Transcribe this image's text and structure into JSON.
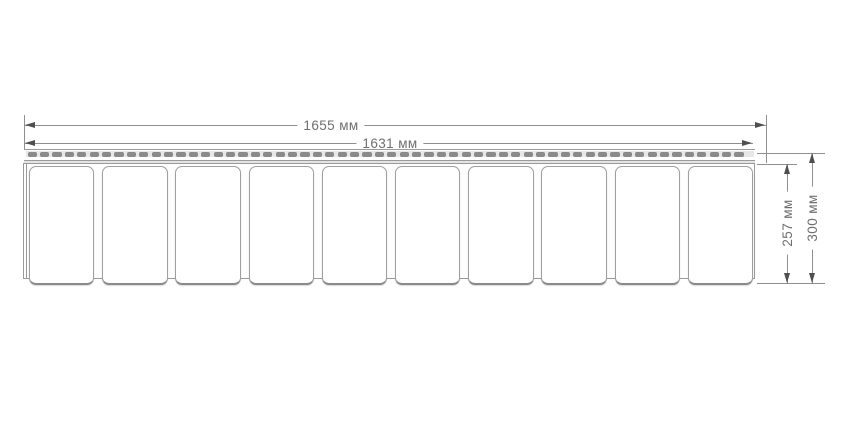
{
  "drawing": {
    "kind": "technical-dimension-diagram",
    "subject": "vinyl-siding-shake-panel-front-view",
    "panels": {
      "count": 10
    },
    "nail_slots": {
      "count": 58
    },
    "dimensions": {
      "width_outer": {
        "value": 1655,
        "unit": "мм",
        "label": "1655 мм"
      },
      "width_inner": {
        "value": 1631,
        "unit": "мм",
        "label": "1631 мм"
      },
      "height_inner": {
        "value": 257,
        "unit": "мм",
        "label": "257 мм"
      },
      "height_outer": {
        "value": 300,
        "unit": "мм",
        "label": "300 мм"
      }
    },
    "colors": {
      "line": "#9a9a9a",
      "dim": "#8f8f8f",
      "arrow": "#4f4f4f",
      "text": "#6f6f6f",
      "slot": "#8a8a8a",
      "slot_bg": "#e7e7e7",
      "band": "#e4e4e4",
      "panel_border": "#9f9f9f",
      "panel_fill": "#ffffff",
      "backing": "#fdfdfd"
    }
  }
}
